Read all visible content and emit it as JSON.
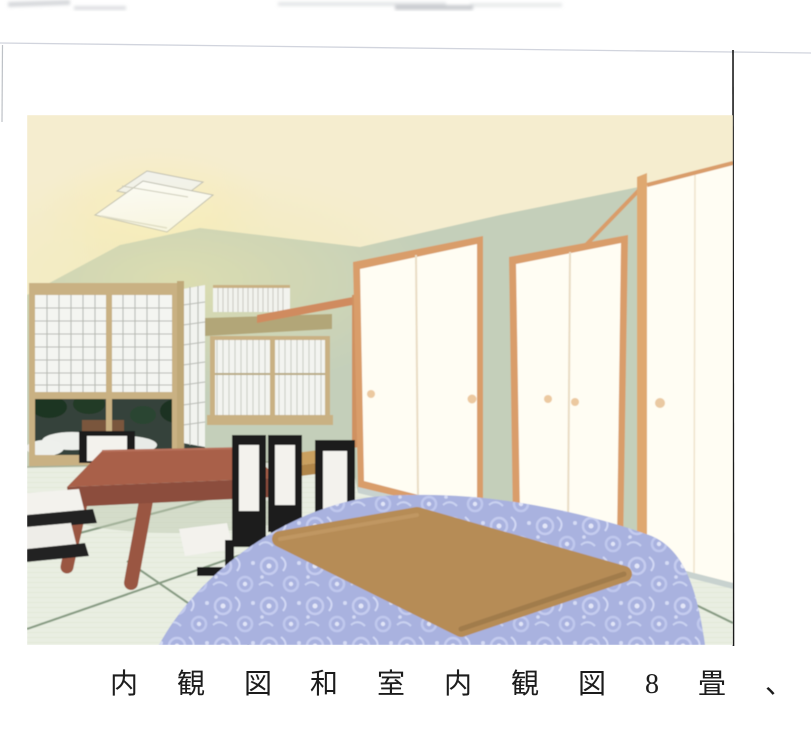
{
  "caption": {
    "label": "内 観 図",
    "description": "和 室 内 観 図 8 畳 、 6 畳"
  },
  "colors": {
    "page_bg": "#ffffff",
    "ceiling": "#f5edcf",
    "ceiling_glow": "#fdf3cb",
    "wall_green": "#c4cfba",
    "wood_frame_tan": "#c9b183",
    "wood_frame_orange": "#d99d6a",
    "beam_khaki": "#b2a678",
    "post_orange": "#cf9160",
    "shoji_paper": "#f4f5f1",
    "fusuma_panel": "#fffdf3",
    "window_dark": "#36433a",
    "tatami": "#e9eee2",
    "tatami_border": "#7e947a",
    "table_wood": "#a9604a",
    "table_wood_dark": "#8c4e3d",
    "chair_black": "#1e1e1e",
    "cushion_white": "#f3f2ed",
    "side_table_tan": "#c9a05f",
    "kotatsu_futon_blue": "#a9b2df",
    "kotatsu_top_tan": "#b68c57",
    "baseboard_gray": "#c9d2d2",
    "caption_text": "#1c1c1c",
    "scan_line_black": "#1a1a1a",
    "scan_line_faint": "#c9cdd8"
  }
}
